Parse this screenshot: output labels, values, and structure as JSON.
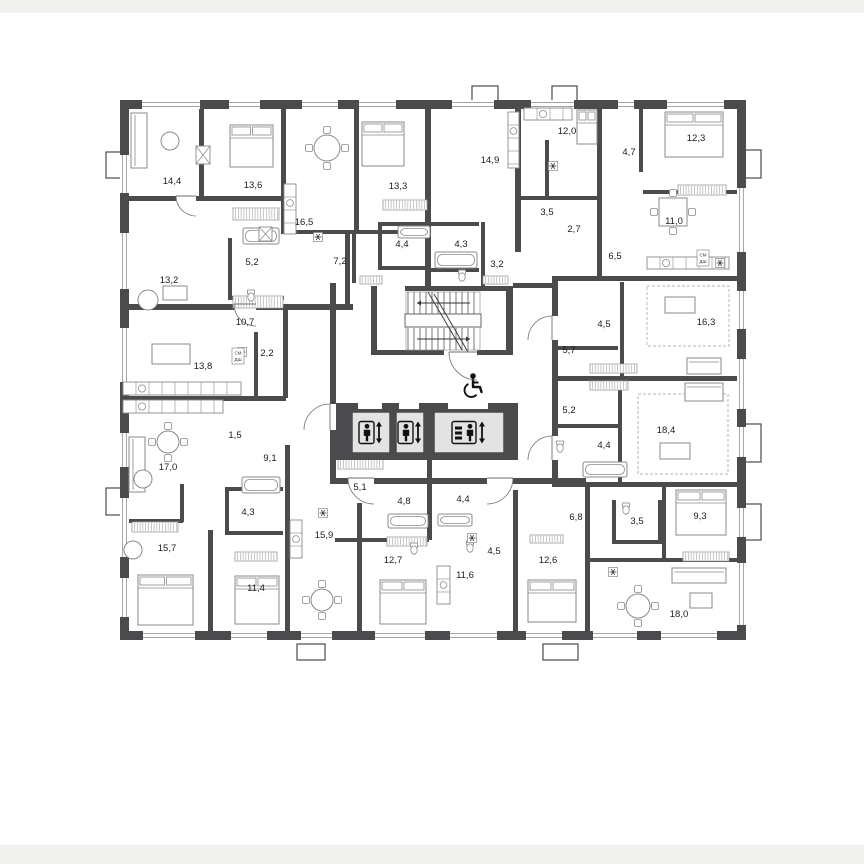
{
  "plan": {
    "colors": {
      "wall": "#4b4b4d",
      "paper": "#ffffff",
      "margin": "#f1f1ef",
      "furniture": "#8a8a88",
      "thin": "#9a9a98",
      "label": "#1c1c1c",
      "elevator_fill": "#e3e3e1",
      "dash": "#b5b5b3",
      "icon": "#111111"
    },
    "margins": {
      "top_h": 13,
      "bottom_y": 845,
      "bottom_h": 19
    },
    "rooms": [
      {
        "label": "14,4",
        "x": 172,
        "y": 181
      },
      {
        "label": "13,6",
        "x": 253,
        "y": 185
      },
      {
        "label": "16,5",
        "x": 304,
        "y": 222
      },
      {
        "label": "13,3",
        "x": 398,
        "y": 186
      },
      {
        "label": "14,9",
        "x": 490,
        "y": 160
      },
      {
        "label": "12,0",
        "x": 567,
        "y": 131
      },
      {
        "label": "4,7",
        "x": 629,
        "y": 152
      },
      {
        "label": "12,3",
        "x": 696,
        "y": 138
      },
      {
        "label": "13,2",
        "x": 169,
        "y": 280
      },
      {
        "label": "5,2",
        "x": 252,
        "y": 262
      },
      {
        "label": "7,2",
        "x": 340,
        "y": 261
      },
      {
        "label": "4,4",
        "x": 402,
        "y": 244
      },
      {
        "label": "4,3",
        "x": 461,
        "y": 244
      },
      {
        "label": "3,2",
        "x": 497,
        "y": 264
      },
      {
        "label": "3,5",
        "x": 547,
        "y": 212
      },
      {
        "label": "2,7",
        "x": 574,
        "y": 229
      },
      {
        "label": "6,5",
        "x": 615,
        "y": 256
      },
      {
        "label": "11,0",
        "x": 674,
        "y": 221
      },
      {
        "label": "10,7",
        "x": 245,
        "y": 322
      },
      {
        "label": "2,2",
        "x": 267,
        "y": 353
      },
      {
        "label": "13,8",
        "x": 203,
        "y": 366
      },
      {
        "label": "4,5",
        "x": 604,
        "y": 324
      },
      {
        "label": "5,7",
        "x": 569,
        "y": 350
      },
      {
        "label": "16,3",
        "x": 706,
        "y": 322
      },
      {
        "label": "5,2",
        "x": 569,
        "y": 410
      },
      {
        "label": "1,5",
        "x": 235,
        "y": 435
      },
      {
        "label": "9,1",
        "x": 270,
        "y": 458
      },
      {
        "label": "17,0",
        "x": 168,
        "y": 467
      },
      {
        "label": "4,4",
        "x": 604,
        "y": 445
      },
      {
        "label": "18,4",
        "x": 666,
        "y": 430
      },
      {
        "label": "15,7",
        "x": 167,
        "y": 548
      },
      {
        "label": "4,3",
        "x": 248,
        "y": 512
      },
      {
        "label": "15,9",
        "x": 324,
        "y": 535
      },
      {
        "label": "5,1",
        "x": 360,
        "y": 487
      },
      {
        "label": "4,8",
        "x": 404,
        "y": 501
      },
      {
        "label": "4,4",
        "x": 463,
        "y": 499
      },
      {
        "label": "12,7",
        "x": 393,
        "y": 560
      },
      {
        "label": "11,6",
        "x": 465,
        "y": 575
      },
      {
        "label": "4,5",
        "x": 494,
        "y": 551
      },
      {
        "label": "12,6",
        "x": 548,
        "y": 560
      },
      {
        "label": "6,8",
        "x": 576,
        "y": 517
      },
      {
        "label": "3,5",
        "x": 637,
        "y": 521
      },
      {
        "label": "9,3",
        "x": 700,
        "y": 516
      },
      {
        "label": "18,0",
        "x": 679,
        "y": 614
      },
      {
        "label": "11,4",
        "x": 256,
        "y": 588
      }
    ],
    "appliances": [
      {
        "line1": "СМ",
        "line2": "ДШ",
        "x": 238,
        "y": 356
      },
      {
        "line1": "СМ",
        "line2": "ДШ",
        "x": 703,
        "y": 258
      }
    ],
    "outer_walls": [
      [
        121,
        100,
        625,
        9
      ],
      [
        121,
        631,
        625,
        9
      ],
      [
        120,
        100,
        9,
        540
      ],
      [
        737,
        100,
        9,
        540
      ]
    ],
    "walls": [
      [
        199,
        106,
        5,
        92
      ],
      [
        281,
        106,
        5,
        126
      ],
      [
        354,
        106,
        5,
        126
      ],
      [
        425,
        106,
        6,
        182
      ],
      [
        515,
        106,
        6,
        146
      ],
      [
        597,
        106,
        5,
        172
      ],
      [
        639,
        106,
        4,
        66
      ],
      [
        545,
        140,
        4,
        58
      ],
      [
        481,
        222,
        4,
        68
      ],
      [
        378,
        222,
        4,
        46
      ],
      [
        352,
        232,
        4,
        51
      ],
      [
        283,
        306,
        5,
        92
      ],
      [
        345,
        232,
        5,
        76
      ],
      [
        228,
        238,
        4,
        60
      ],
      [
        254,
        332,
        4,
        66
      ],
      [
        330,
        283,
        6,
        121
      ],
      [
        330,
        430,
        6,
        54
      ],
      [
        371,
        286,
        6,
        68
      ],
      [
        506,
        286,
        7,
        68
      ],
      [
        552,
        276,
        6,
        206
      ],
      [
        620,
        282,
        4,
        96
      ],
      [
        618,
        380,
        4,
        102
      ],
      [
        285,
        445,
        5,
        186
      ],
      [
        357,
        503,
        5,
        128
      ],
      [
        427,
        460,
        5,
        80
      ],
      [
        513,
        490,
        5,
        141
      ],
      [
        585,
        484,
        5,
        147
      ],
      [
        662,
        484,
        4,
        76
      ],
      [
        208,
        530,
        5,
        101
      ],
      [
        180,
        484,
        4,
        38
      ],
      [
        225,
        487,
        4,
        48
      ],
      [
        612,
        500,
        4,
        44
      ],
      [
        658,
        500,
        4,
        44
      ],
      [
        121,
        196,
        165,
        5
      ],
      [
        281,
        230,
        150,
        4
      ],
      [
        515,
        196,
        86,
        4
      ],
      [
        643,
        190,
        94,
        4
      ],
      [
        556,
        276,
        182,
        5
      ],
      [
        121,
        304,
        232,
        6
      ],
      [
        121,
        396,
        165,
        5
      ],
      [
        405,
        286,
        108,
        5
      ],
      [
        371,
        350,
        73,
        5
      ],
      [
        477,
        350,
        36,
        5
      ],
      [
        330,
        478,
        256,
        6
      ],
      [
        552,
        482,
        194,
        5
      ],
      [
        556,
        376,
        182,
        5
      ],
      [
        335,
        538,
        94,
        4
      ],
      [
        121,
        519,
        62,
        4
      ],
      [
        225,
        487,
        58,
        4
      ],
      [
        225,
        531,
        58,
        4
      ],
      [
        588,
        558,
        150,
        4
      ],
      [
        612,
        540,
        50,
        4
      ],
      [
        431,
        222,
        48,
        4
      ],
      [
        378,
        222,
        47,
        4
      ],
      [
        378,
        266,
        47,
        4
      ],
      [
        431,
        268,
        48,
        4
      ],
      [
        558,
        346,
        60,
        4
      ],
      [
        558,
        424,
        60,
        4
      ],
      [
        513,
        283,
        39,
        5
      ],
      [
        228,
        296,
        56,
        4
      ]
    ],
    "gaps": [
      [
        358,
        404,
        24,
        7
      ],
      [
        399,
        404,
        20,
        7
      ],
      [
        448,
        404,
        40,
        7
      ],
      [
        348,
        478,
        26,
        6
      ],
      [
        487,
        478,
        26,
        6
      ],
      [
        552,
        316,
        6,
        24
      ],
      [
        552,
        436,
        6,
        24
      ],
      [
        234,
        304,
        22,
        6
      ],
      [
        176,
        196,
        20,
        5
      ]
    ],
    "windows": {
      "top": [
        [
          139,
          64
        ],
        [
          226,
          37
        ],
        [
          299,
          42
        ],
        [
          356,
          43
        ],
        [
          449,
          48
        ],
        [
          528,
          49
        ],
        [
          615,
          22
        ],
        [
          664,
          63
        ]
      ],
      "bottom": [
        [
          140,
          58
        ],
        [
          228,
          42
        ],
        [
          298,
          37
        ],
        [
          372,
          56
        ],
        [
          447,
          53
        ],
        [
          523,
          42
        ],
        [
          590,
          50
        ],
        [
          658,
          62
        ]
      ],
      "left": [
        [
          152,
          44
        ],
        [
          230,
          62
        ],
        [
          325,
          60
        ],
        [
          430,
          40
        ],
        [
          495,
          65
        ],
        [
          575,
          45
        ]
      ],
      "right": [
        [
          185,
          70
        ],
        [
          288,
          44
        ],
        [
          356,
          56
        ],
        [
          424,
          36
        ],
        [
          505,
          35
        ],
        [
          560,
          68
        ]
      ]
    },
    "tabs": [
      [
        472,
        86,
        26,
        15
      ],
      [
        552,
        86,
        25,
        15
      ],
      [
        106,
        152,
        15,
        26
      ],
      [
        106,
        488,
        15,
        27
      ],
      [
        745,
        150,
        16,
        28
      ],
      [
        745,
        424,
        16,
        38
      ],
      [
        745,
        504,
        16,
        36
      ],
      [
        297,
        644,
        28,
        16
      ],
      [
        543,
        644,
        35,
        16
      ]
    ],
    "hatches": [
      [
        233,
        208,
        46,
        12
      ],
      [
        233,
        296,
        50,
        12
      ],
      [
        338,
        458,
        45,
        11
      ],
      [
        360,
        276,
        22,
        8
      ],
      [
        483,
        276,
        25,
        8
      ],
      [
        678,
        185,
        48,
        10
      ],
      [
        590,
        364,
        47,
        9
      ],
      [
        590,
        381,
        38,
        9
      ],
      [
        683,
        552,
        46,
        9
      ],
      [
        132,
        522,
        46,
        10
      ],
      [
        387,
        537,
        40,
        9
      ],
      [
        235,
        552,
        42,
        9
      ],
      [
        383,
        200,
        44,
        10
      ],
      [
        530,
        535,
        33,
        8
      ]
    ],
    "dashed_zones": [
      [
        647,
        286,
        82,
        60
      ],
      [
        638,
        394,
        90,
        80
      ]
    ],
    "vents": [
      [
        196,
        146,
        14,
        18
      ],
      [
        259,
        227,
        13,
        14
      ]
    ],
    "snowflakes": [
      [
        318,
        237
      ],
      [
        553,
        166
      ],
      [
        720,
        263
      ],
      [
        242,
        352
      ],
      [
        323,
        513
      ],
      [
        472,
        538
      ],
      [
        613,
        572
      ]
    ],
    "stairs": {
      "x1": 408,
      "x2": 478,
      "up_y1": 292,
      "up_y2": 315,
      "low_y1": 328,
      "low_y2": 350,
      "landing": [
        405,
        314,
        76,
        13
      ],
      "break": [
        428,
        292,
        462,
        350
      ],
      "step": 6,
      "arrow_up": [
        470,
        303,
        417,
        303
      ],
      "arrow_low": [
        417,
        339,
        470,
        339
      ]
    },
    "elevators": {
      "block": [
        336,
        403,
        182,
        57
      ],
      "cars": [
        {
          "rect": [
            352,
            412,
            38,
            41
          ],
          "freight": false
        },
        {
          "rect": [
            396,
            412,
            28,
            41
          ],
          "freight": false
        },
        {
          "rect": [
            434,
            412,
            70,
            41
          ],
          "freight": true
        }
      ]
    },
    "wheelchair": {
      "x": 472,
      "y": 386
    },
    "doors": [
      {
        "hx": 330,
        "hy": 430,
        "r": 26,
        "a1": -90,
        "a2": -180
      },
      {
        "hx": 477,
        "hy": 352,
        "r": 28,
        "a1": 180,
        "a2": 90
      },
      {
        "hx": 374,
        "hy": 478,
        "r": 26,
        "a1": 180,
        "a2": 90
      },
      {
        "hx": 487,
        "hy": 478,
        "r": 26,
        "a1": 0,
        "a2": 90
      },
      {
        "hx": 552,
        "hy": 340,
        "r": 24,
        "a1": -90,
        "a2": -180
      },
      {
        "hx": 552,
        "hy": 460,
        "r": 24,
        "a1": -90,
        "a2": -180
      },
      {
        "hx": 256,
        "hy": 304,
        "r": 22,
        "a1": 180,
        "a2": 90
      },
      {
        "hx": 196,
        "hy": 196,
        "r": 20,
        "a1": 180,
        "a2": 90
      }
    ],
    "furniture": {
      "beds": [
        [
          230,
          125,
          43,
          42
        ],
        [
          362,
          122,
          42,
          44
        ],
        [
          665,
          112,
          58,
          45
        ],
        [
          138,
          575,
          55,
          50
        ],
        [
          235,
          576,
          44,
          48
        ],
        [
          380,
          580,
          46,
          44
        ],
        [
          528,
          580,
          48,
          42
        ],
        [
          676,
          490,
          50,
          45
        ],
        [
          577,
          110,
          20,
          34
        ]
      ],
      "sofas": [
        [
          131,
          113,
          16,
          55
        ],
        [
          129,
          437,
          16,
          55
        ],
        [
          672,
          568,
          54,
          15
        ],
        [
          687,
          358,
          34,
          16
        ],
        [
          685,
          383,
          38,
          18
        ]
      ],
      "round_tables": [
        [
          327,
          148,
          13
        ],
        [
          168,
          442,
          11
        ],
        [
          322,
          600,
          11
        ],
        [
          638,
          606,
          12
        ]
      ],
      "square_tables": [
        [
          673,
          212,
          28
        ]
      ],
      "rect_tables": [
        [
          152,
          344,
          38,
          20
        ],
        [
          665,
          297,
          30,
          16
        ],
        [
          660,
          443,
          30,
          16
        ],
        [
          163,
          286,
          24,
          14
        ],
        [
          690,
          593,
          22,
          15
        ]
      ],
      "armchairs": [
        [
          170,
          141,
          9
        ],
        [
          148,
          300,
          10
        ],
        [
          143,
          479,
          9
        ],
        [
          133,
          550,
          9
        ]
      ],
      "tubs": [
        [
          243,
          228,
          36,
          16
        ],
        [
          435,
          252,
          42,
          16
        ],
        [
          398,
          226,
          32,
          12
        ],
        [
          388,
          514,
          40,
          14
        ],
        [
          438,
          514,
          34,
          12
        ],
        [
          583,
          462,
          44,
          15
        ],
        [
          242,
          477,
          38,
          16
        ]
      ],
      "counters_h": [
        [
          123,
          382,
          118,
          13
        ],
        [
          123,
          400,
          100,
          13
        ],
        [
          524,
          108,
          48,
          12
        ],
        [
          647,
          257,
          82,
          12
        ]
      ],
      "counters_v": [
        [
          284,
          184,
          12,
          50
        ],
        [
          508,
          112,
          11,
          56
        ],
        [
          437,
          566,
          13,
          38
        ],
        [
          290,
          520,
          12,
          38
        ]
      ],
      "wcs": [
        [
          251,
          296
        ],
        [
          462,
          276
        ],
        [
          414,
          549
        ],
        [
          470,
          547
        ],
        [
          560,
          447
        ],
        [
          626,
          509
        ]
      ]
    }
  }
}
